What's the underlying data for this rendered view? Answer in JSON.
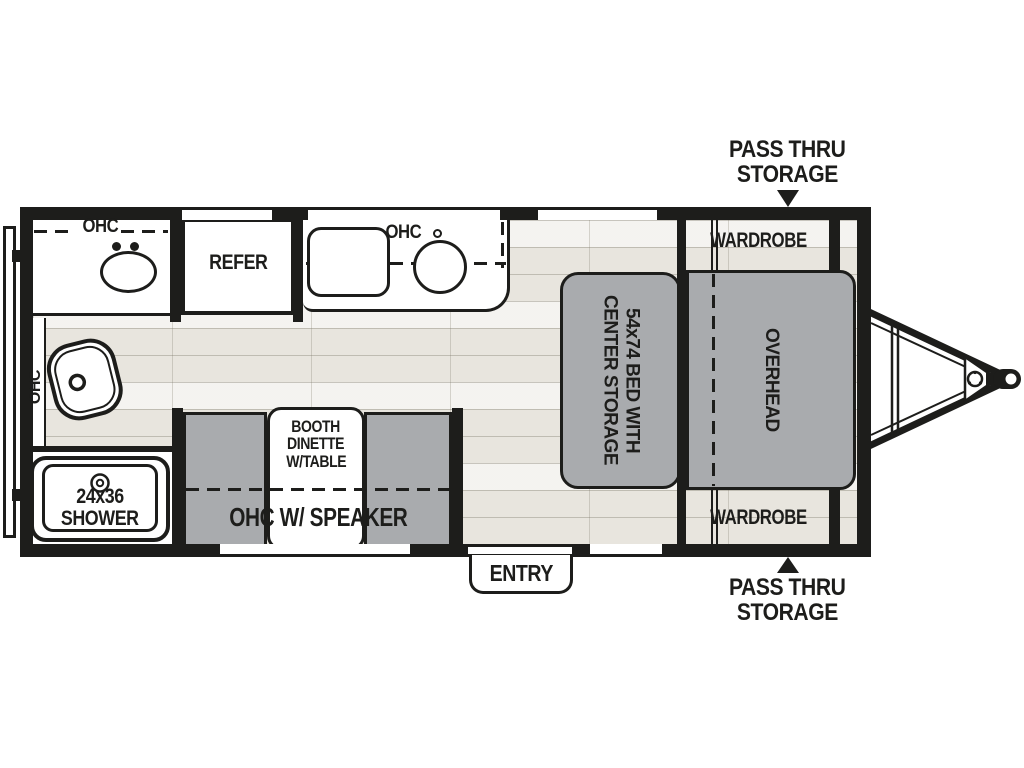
{
  "title": "Travel trailer floorplan",
  "colors": {
    "wall": "#1d1d1b",
    "furniture_gray": "#a9abae",
    "floor": "#e8e5de",
    "white": "#ffffff"
  },
  "labels": {
    "pass_thru_top": {
      "line1": "PASS THRU",
      "line2": "STORAGE"
    },
    "pass_thru_bottom": {
      "line1": "PASS THRU",
      "line2": "STORAGE"
    },
    "wardrobe_top": "WARDROBE",
    "wardrobe_bottom": "WARDROBE",
    "overhead": "OVERHEAD",
    "bed": {
      "line1": "54x74 BED WITH",
      "line2": "CENTER STORAGE"
    },
    "refer": "REFER",
    "ohc_bath": "OHC",
    "ohc_kitchen": "OHC",
    "ohc_left": "OHC",
    "booth": {
      "line1": "BOOTH",
      "line2": "DINETTE",
      "line3": "W/TABLE"
    },
    "ohc_speaker": "OHC W/ SPEAKER",
    "shower": {
      "line1": "24x36",
      "line2": "SHOWER"
    },
    "entry": "ENTRY"
  }
}
